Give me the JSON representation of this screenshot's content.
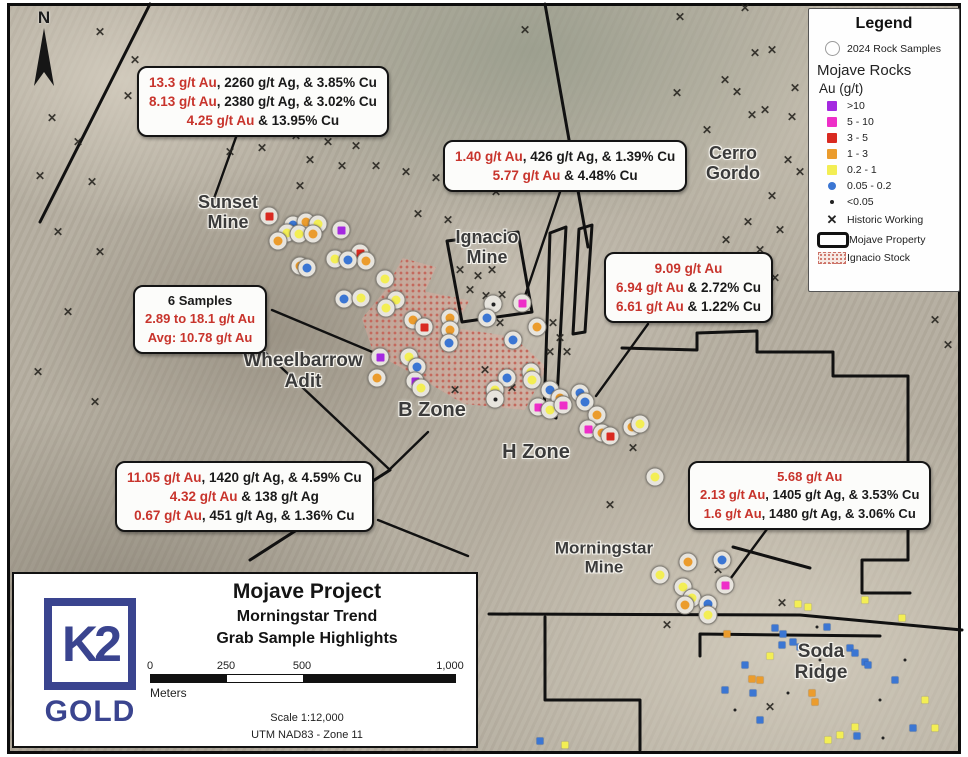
{
  "colors": {
    "red_text": "#c8342c",
    "logo_navy": "#3a448f",
    "map_line": "#111111"
  },
  "marker_colors": {
    "p": "#a429e0",
    "m": "#ee2ec8",
    "r": "#d92a21",
    "o": "#eb9c2d",
    "y": "#f3ee54",
    "b": "#3b76d3",
    "t": "#222222"
  },
  "icons": {
    "historic_working_glyph": "✕"
  },
  "north": {
    "label": "N"
  },
  "legend": {
    "title": "Legend",
    "rock_samples_label": "2024 Rock Samples",
    "section": "Mojave Rocks",
    "subsection": "Au (g/t)",
    "classes": [
      {
        "label": ">10",
        "color": "#a429e0",
        "shape": "square"
      },
      {
        "label": "5 - 10",
        "color": "#ee2ec8",
        "shape": "square"
      },
      {
        "label": "3 - 5",
        "color": "#d92a21",
        "shape": "square"
      },
      {
        "label": "1 - 3",
        "color": "#eb9c2d",
        "shape": "square"
      },
      {
        "label": "0.2 - 1",
        "color": "#f3ee54",
        "shape": "square"
      },
      {
        "label": "0.05 - 0.2",
        "color": "#3b76d3",
        "shape": "dot"
      },
      {
        "label": "<0.05",
        "color": "#222222",
        "shape": "tinydot"
      }
    ],
    "historic_label": "Historic Working",
    "property_label": "Mojave Property",
    "stock_label": "Ignacio Stock"
  },
  "annotations": [
    {
      "lines": [
        [
          {
            "t": "13.3 g/t Au",
            "c": "r"
          },
          {
            "t": ", 2260 g/t Ag, & 3.85% Cu",
            "c": "k"
          }
        ],
        [
          {
            "t": "8.13 g/t Au",
            "c": "r"
          },
          {
            "t": ", 2380 g/t Ag, & 3.02% Cu",
            "c": "k"
          }
        ],
        [
          {
            "t": "4.25 g/t Au",
            "c": "r"
          },
          {
            "t": " & 13.95% Cu",
            "c": "k"
          }
        ]
      ]
    },
    {
      "lines": [
        [
          {
            "t": "1.40 g/t Au",
            "c": "r"
          },
          {
            "t": ", 426 g/t Ag, & 1.39% Cu",
            "c": "k"
          }
        ],
        [
          {
            "t": "5.77 g/t Au",
            "c": "r"
          },
          {
            "t": " & 4.48% Cu",
            "c": "k"
          }
        ]
      ]
    },
    {
      "lines": [
        [
          {
            "t": "9.09 g/t Au",
            "c": "r"
          }
        ],
        [
          {
            "t": "6.94 g/t Au",
            "c": "r"
          },
          {
            "t": " & 2.72% Cu",
            "c": "k"
          }
        ],
        [
          {
            "t": "6.61 g/t Au",
            "c": "r"
          },
          {
            "t": " & 1.22% Cu",
            "c": "k"
          }
        ]
      ]
    },
    {
      "lines": [
        [
          {
            "t": "6 Samples",
            "c": "k"
          }
        ],
        [
          {
            "t": "2.89 to 18.1 g/t Au",
            "c": "r"
          }
        ],
        [
          {
            "t": "Avg: 10.78 g/t Au",
            "c": "r"
          }
        ]
      ]
    },
    {
      "lines": [
        [
          {
            "t": "11.05 g/t Au",
            "c": "r"
          },
          {
            "t": ", 1420 g/t Ag, & 4.59% Cu",
            "c": "k"
          }
        ],
        [
          {
            "t": "4.32 g/t Au",
            "c": "r"
          },
          {
            "t": " & 138 g/t Ag",
            "c": "k"
          }
        ],
        [
          {
            "t": "0.67 g/t Au",
            "c": "r"
          },
          {
            "t": ", 451 g/t Ag, & 1.36% Cu",
            "c": "k"
          }
        ]
      ]
    },
    {
      "lines": [
        [
          {
            "t": "5.68 g/t Au",
            "c": "r"
          }
        ],
        [
          {
            "t": "2.13 g/t Au",
            "c": "r"
          },
          {
            "t": ", 1405 g/t Ag, & 3.53% Cu",
            "c": "k"
          }
        ],
        [
          {
            "t": "1.6 g/t Au",
            "c": "r"
          },
          {
            "t": ", 1480 g/t Ag, & 3.06% Cu",
            "c": "k"
          }
        ]
      ]
    }
  ],
  "labels": [
    {
      "lines": [
        "Sunset",
        "Mine"
      ]
    },
    {
      "lines": [
        "Ignacio",
        "Mine"
      ]
    },
    {
      "lines": [
        "Cerro",
        "Gordo"
      ]
    },
    {
      "lines": [
        "Wheelbarrow",
        "Adit"
      ]
    },
    {
      "lines": [
        "B Zone"
      ]
    },
    {
      "lines": [
        "H Zone"
      ]
    },
    {
      "lines": [
        "Morningstar",
        "Mine"
      ]
    },
    {
      "lines": [
        "Soda",
        "Ridge"
      ]
    }
  ],
  "title_box": {
    "title": "Mojave Project",
    "subtitle1": "Morningstar Trend",
    "subtitle2": "Grab Sample Highlights",
    "scale_ticks": [
      "0",
      "250",
      "500",
      "1,000"
    ],
    "units": "Meters",
    "scale_text": "Scale 1:12,000",
    "datum_text": "UTM NAD83 - Zone 11",
    "logo_top": "K2",
    "logo_bottom": "GOLD"
  },
  "samples": [
    [
      269,
      216,
      "r",
      1
    ],
    [
      293,
      225,
      "b",
      1
    ],
    [
      306,
      222,
      "o",
      1
    ],
    [
      318,
      224,
      "y",
      1
    ],
    [
      287,
      233,
      "y",
      1
    ],
    [
      299,
      234,
      "y",
      1
    ],
    [
      278,
      241,
      "o",
      1
    ],
    [
      313,
      234,
      "o",
      1
    ],
    [
      341,
      230,
      "p",
      1
    ],
    [
      300,
      266,
      "o",
      1
    ],
    [
      307,
      268,
      "b",
      1
    ],
    [
      360,
      253,
      "r",
      1
    ],
    [
      366,
      261,
      "o",
      1
    ],
    [
      335,
      259,
      "y",
      1
    ],
    [
      348,
      260,
      "b",
      1
    ],
    [
      385,
      279,
      "y",
      1
    ],
    [
      344,
      299,
      "b",
      1
    ],
    [
      361,
      298,
      "y",
      1
    ],
    [
      396,
      300,
      "y",
      1
    ],
    [
      386,
      308,
      "y",
      1
    ],
    [
      413,
      320,
      "o",
      1
    ],
    [
      424,
      327,
      "r",
      1
    ],
    [
      450,
      318,
      "o",
      1
    ],
    [
      450,
      330,
      "o",
      1
    ],
    [
      449,
      343,
      "b",
      1
    ],
    [
      380,
      357,
      "p",
      1
    ],
    [
      377,
      378,
      "o",
      1
    ],
    [
      409,
      357,
      "y",
      1
    ],
    [
      417,
      367,
      "b",
      1
    ],
    [
      415,
      381,
      "p",
      1
    ],
    [
      421,
      388,
      "y",
      1
    ],
    [
      493,
      304,
      "t",
      1
    ],
    [
      522,
      303,
      "m",
      1
    ],
    [
      487,
      318,
      "b",
      1
    ],
    [
      537,
      327,
      "o",
      1
    ],
    [
      513,
      340,
      "b",
      1
    ],
    [
      531,
      372,
      "y",
      1
    ],
    [
      532,
      380,
      "y",
      1
    ],
    [
      507,
      378,
      "b",
      1
    ],
    [
      495,
      390,
      "y",
      1
    ],
    [
      495,
      399,
      "t",
      1
    ],
    [
      550,
      390,
      "b",
      1
    ],
    [
      560,
      398,
      "o",
      1
    ],
    [
      538,
      407,
      "m",
      1
    ],
    [
      550,
      410,
      "y",
      1
    ],
    [
      563,
      405,
      "m",
      1
    ],
    [
      580,
      393,
      "b",
      1
    ],
    [
      585,
      402,
      "b",
      1
    ],
    [
      597,
      415,
      "o",
      1
    ],
    [
      588,
      429,
      "m",
      1
    ],
    [
      602,
      433,
      "o",
      1
    ],
    [
      610,
      436,
      "r",
      1
    ],
    [
      632,
      427,
      "o",
      1
    ],
    [
      640,
      424,
      "y",
      1
    ],
    [
      655,
      477,
      "y",
      1
    ],
    [
      688,
      562,
      "o",
      1
    ],
    [
      722,
      560,
      "b",
      1
    ],
    [
      660,
      575,
      "y",
      1
    ],
    [
      683,
      587,
      "y",
      1
    ],
    [
      725,
      585,
      "m",
      1
    ],
    [
      692,
      598,
      "y",
      1
    ],
    [
      685,
      605,
      "o",
      1
    ],
    [
      708,
      604,
      "b",
      1
    ],
    [
      708,
      615,
      "y",
      1
    ],
    [
      727,
      634,
      "o",
      0
    ],
    [
      783,
      634,
      "b",
      0
    ],
    [
      782,
      645,
      "b",
      0
    ],
    [
      798,
      604,
      "y",
      0
    ],
    [
      808,
      607,
      "y",
      0
    ],
    [
      775,
      628,
      "b",
      0
    ],
    [
      793,
      642,
      "b",
      0
    ],
    [
      800,
      647,
      "b",
      0
    ],
    [
      817,
      627,
      "t",
      0
    ],
    [
      827,
      627,
      "b",
      0
    ],
    [
      752,
      679,
      "o",
      0
    ],
    [
      760,
      680,
      "o",
      0
    ],
    [
      753,
      693,
      "b",
      0
    ],
    [
      770,
      656,
      "y",
      0
    ],
    [
      812,
      693,
      "o",
      0
    ],
    [
      815,
      702,
      "o",
      0
    ],
    [
      850,
      648,
      "b",
      0
    ],
    [
      855,
      653,
      "b",
      0
    ],
    [
      865,
      662,
      "b",
      0
    ],
    [
      868,
      665,
      "b",
      0
    ],
    [
      788,
      693,
      "t",
      0
    ],
    [
      855,
      727,
      "y",
      0
    ],
    [
      840,
      735,
      "y",
      0
    ],
    [
      857,
      736,
      "b",
      0
    ],
    [
      935,
      728,
      "y",
      0
    ],
    [
      913,
      728,
      "b",
      0
    ],
    [
      828,
      740,
      "y",
      0
    ],
    [
      883,
      738,
      "t",
      0
    ],
    [
      865,
      600,
      "y",
      0
    ],
    [
      902,
      618,
      "y",
      0
    ],
    [
      540,
      741,
      "b",
      0
    ],
    [
      565,
      745,
      "y",
      0
    ],
    [
      760,
      720,
      "b",
      0
    ],
    [
      735,
      710,
      "t",
      0
    ],
    [
      745,
      665,
      "b",
      0
    ],
    [
      725,
      690,
      "b",
      0
    ],
    [
      880,
      700,
      "t",
      0
    ],
    [
      820,
      660,
      "t",
      0
    ],
    [
      905,
      660,
      "t",
      0
    ],
    [
      895,
      680,
      "b",
      0
    ],
    [
      925,
      700,
      "y",
      0
    ]
  ],
  "historic_workings": [
    [
      100,
      32
    ],
    [
      135,
      60
    ],
    [
      52,
      118
    ],
    [
      78,
      142
    ],
    [
      40,
      176
    ],
    [
      92,
      182
    ],
    [
      128,
      96
    ],
    [
      58,
      232
    ],
    [
      100,
      252
    ],
    [
      68,
      312
    ],
    [
      38,
      372
    ],
    [
      95,
      402
    ],
    [
      230,
      152
    ],
    [
      262,
      148
    ],
    [
      296,
      136
    ],
    [
      328,
      142
    ],
    [
      356,
      146
    ],
    [
      310,
      160
    ],
    [
      342,
      166
    ],
    [
      376,
      166
    ],
    [
      406,
      172
    ],
    [
      436,
      178
    ],
    [
      466,
      184
    ],
    [
      496,
      192
    ],
    [
      418,
      214
    ],
    [
      448,
      220
    ],
    [
      300,
      186
    ],
    [
      525,
      30
    ],
    [
      680,
      17
    ],
    [
      745,
      8
    ],
    [
      772,
      50
    ],
    [
      755,
      53
    ],
    [
      725,
      80
    ],
    [
      677,
      93
    ],
    [
      737,
      92
    ],
    [
      795,
      88
    ],
    [
      765,
      110
    ],
    [
      752,
      115
    ],
    [
      792,
      117
    ],
    [
      707,
      130
    ],
    [
      788,
      160
    ],
    [
      800,
      172
    ],
    [
      772,
      196
    ],
    [
      748,
      222
    ],
    [
      780,
      230
    ],
    [
      760,
      250
    ],
    [
      726,
      240
    ],
    [
      744,
      270
    ],
    [
      775,
      278
    ],
    [
      460,
      270
    ],
    [
      478,
      276
    ],
    [
      492,
      270
    ],
    [
      470,
      290
    ],
    [
      486,
      296
    ],
    [
      502,
      295
    ],
    [
      500,
      323
    ],
    [
      553,
      323
    ],
    [
      560,
      338
    ],
    [
      550,
      352
    ],
    [
      567,
      352
    ],
    [
      485,
      370
    ],
    [
      512,
      388
    ],
    [
      455,
      390
    ],
    [
      633,
      448
    ],
    [
      610,
      505
    ],
    [
      718,
      570
    ],
    [
      667,
      625
    ],
    [
      782,
      603
    ],
    [
      770,
      707
    ],
    [
      935,
      320
    ],
    [
      948,
      345
    ]
  ]
}
